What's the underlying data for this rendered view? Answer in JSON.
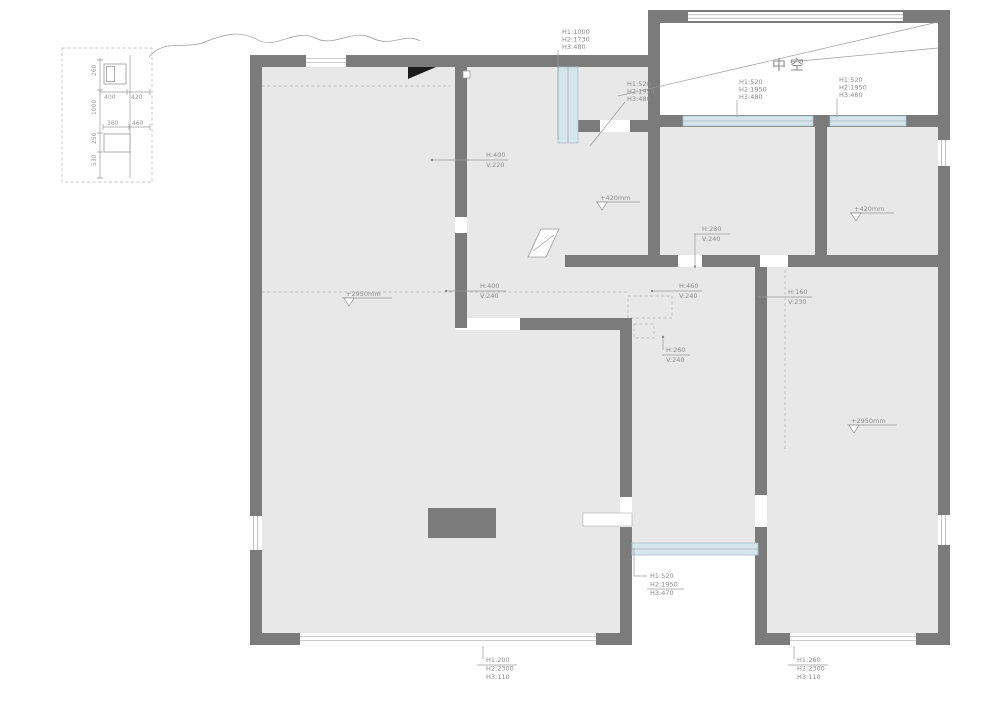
{
  "plan": {
    "void_label": "中空",
    "colors": {
      "wall": "#7b7b7b",
      "floor": "#e8e8e8",
      "window": "#d5e5ec",
      "annotation": "#8c8c8c"
    },
    "inset": {
      "d260": "260",
      "d400": "400",
      "d420": "420",
      "d1000": "1000",
      "d360": "360",
      "d460": "460",
      "d250": "250",
      "d530": "530"
    },
    "annotations": {
      "topLeftWin": {
        "l1": "H1:1000",
        "l2": "H2:1730",
        "l3": "H3:480"
      },
      "topMidWin": {
        "l1": "H1:520",
        "l2": "H2:1950",
        "l3": "H3:480"
      },
      "topRightWin1": {
        "l1": "H1:520",
        "l2": "H2:1950",
        "l3": "H3:480"
      },
      "topRightWin2": {
        "l1": "H1:520",
        "l2": "H2:1950",
        "l3": "H3:480"
      },
      "hallNiche": {
        "l1": "H:400",
        "l2": "V:220"
      },
      "kitchenBeam": {
        "l1": "H:280",
        "l2": "V:240"
      },
      "livingBeam": {
        "l1": "H:400",
        "l2": "V:240"
      },
      "midBeam": {
        "l1": "H:460",
        "l2": "V:240"
      },
      "rightBeam": {
        "l1": "H:160",
        "l2": "V:230"
      },
      "lowerBeam": {
        "l1": "H:260",
        "l2": "V:240"
      },
      "bottomMidWin": {
        "l1": "H1:520",
        "l2": "H2:1950",
        "l3": "H3:470"
      },
      "bottomLeftWin": {
        "l1": "H1:200",
        "l2": "H2:2300",
        "l3": "H3:110"
      },
      "bottomRightWin": {
        "l1": "H1:260",
        "l2": "H2:2300",
        "l3": "H3:110"
      }
    },
    "levels": {
      "bathA": "+420mm",
      "bathB": "+420mm",
      "living": "+2950mm",
      "master": "+2950mm"
    }
  }
}
